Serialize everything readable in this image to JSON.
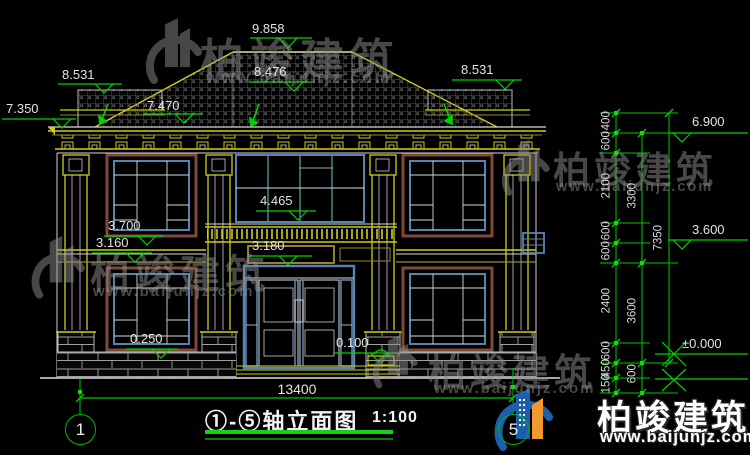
{
  "drawing": {
    "title": "①-⑤轴立面图",
    "scale": "1:100",
    "axis_left": "1",
    "axis_right": "5",
    "overall_width_dim": "13400",
    "elevations": {
      "ridge": "9.858",
      "left_parapet": "8.531",
      "center_upper": "8.476",
      "eave_left": "7.350",
      "eave_mid": "7.470",
      "right_parapet": "8.531",
      "right_upper": "6.900",
      "balcony_top": "4.465",
      "left_lintel": "3.700",
      "left_floor2": "3.160",
      "porch_beam": "3.180",
      "right_floor2": "3.600",
      "window_sill": "0.250",
      "porch_floor": "0.100",
      "ground": "±0.000"
    },
    "dim_chain_inner": [
      "400",
      "600",
      "2100",
      "600",
      "600",
      "2400",
      "600",
      "450",
      "150"
    ],
    "dim_chain_middle": [
      "3300",
      "3600",
      "600"
    ],
    "dim_chain_outer": [
      "7350"
    ]
  },
  "watermark": {
    "brand": "柏竣建筑",
    "url": "www.baijunjz.com"
  },
  "colors": {
    "dim_green": "#00d200",
    "cad_yellow": "#cdcd1a",
    "frame_blue": "#5b82ad",
    "frame_brown": "#7e4a36",
    "logo_blue": "#1b5fae",
    "logo_orange": "#f2992e"
  }
}
